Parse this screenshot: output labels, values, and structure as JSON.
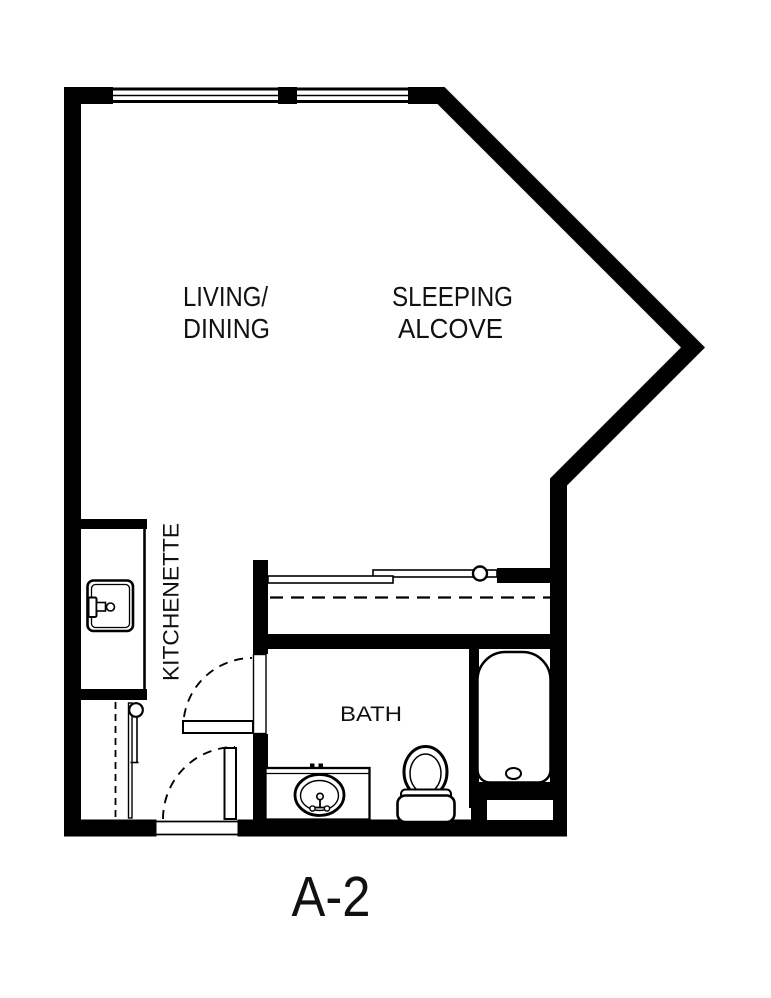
{
  "floorplan": {
    "unit_label": "A-2",
    "labels": {
      "living_line1": "LIVING/",
      "living_line2": "DINING",
      "sleeping_line1": "SLEEPING",
      "sleeping_line2": "ALCOVE",
      "kitchenette": "KITCHENETTE",
      "bath": "BATH"
    },
    "colors": {
      "wall": "#000000",
      "background": "#ffffff",
      "line": "#111111"
    }
  }
}
